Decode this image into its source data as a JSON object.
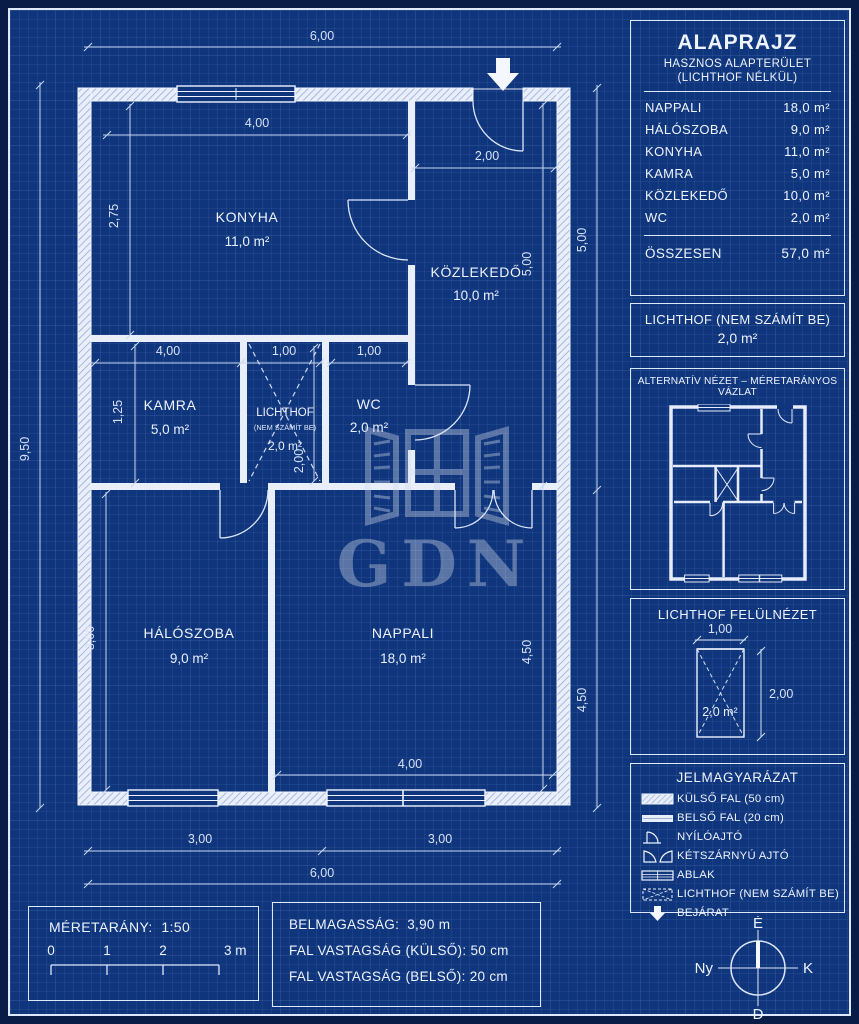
{
  "watermark": "GDN",
  "plan": {
    "rooms": {
      "konyha": {
        "name": "KONYHA",
        "area": "11,0 m²"
      },
      "kozlekedo": {
        "name": "KÖZLEKEDŐ",
        "area": "10,0 m²"
      },
      "kamra": {
        "name": "KAMRA",
        "area": "5,0 m²"
      },
      "lichthof": {
        "name": "LICHTHOF",
        "note": "(NEM SZÁMÍT BE)",
        "area": "2,0 m²"
      },
      "wc": {
        "name": "WC",
        "area": "2,0 m²"
      },
      "haloszoba": {
        "name": "HÁLÓSZOBA",
        "area": "9,0 m²"
      },
      "nappali": {
        "name": "NAPPALI",
        "area": "18,0 m²"
      }
    },
    "dims": {
      "top_total": "6,00",
      "konyha_w": "4,00",
      "entrance_w": "2,00",
      "konyha_h": "2,75",
      "kozlekedo_h": "5,00",
      "right_upper": "5,00",
      "right_lower": "4,50",
      "nappali_h": "4,50",
      "left_total": "9,50",
      "kamra_w": "4,00",
      "lichthof_w": "1,00",
      "wc_w": "1,00",
      "kamra_h": "1,25",
      "lichthof_h": "2,00",
      "haloszoba_h": "3,00",
      "nappali_w": "4,00",
      "bottom_left": "3,00",
      "bottom_right": "3,00",
      "bottom_total": "6,00"
    }
  },
  "sidebar": {
    "summary": {
      "title": "ALAPRAJZ",
      "subtitle1": "HASZNOS ALAPTERÜLET",
      "subtitle2": "(LICHTHOF NÉLKÜL)",
      "rows": [
        {
          "label": "NAPPALI",
          "value": "18,0 m²"
        },
        {
          "label": "HÁLÓSZOBA",
          "value": "9,0 m²"
        },
        {
          "label": "KONYHA",
          "value": "11,0 m²"
        },
        {
          "label": "KAMRA",
          "value": "5,0 m²"
        },
        {
          "label": "KÖZLEKEDŐ",
          "value": "10,0 m²"
        },
        {
          "label": "WC",
          "value": "2,0 m²"
        }
      ],
      "total_label": "ÖSSZESEN",
      "total_value": "57,0 m²"
    },
    "lichthof_note": {
      "line1": "LICHTHOF (NEM SZÁMÍT BE)",
      "line2": "2,0 m²"
    },
    "alt_view": {
      "caption": "ALTERNATÍV NÉZET – MÉRETARÁNYOS VÁZLAT"
    },
    "lichthof_top": {
      "title": "LICHTHOF FELÜLNÉZET",
      "width": "1,00",
      "height": "2,00",
      "area": "2,0 m²"
    },
    "legend": {
      "title": "JELMAGYARÁZAT",
      "items": [
        {
          "label": "KÜLSŐ FAL (50 cm)"
        },
        {
          "label": "BELSŐ FAL (20 cm)"
        },
        {
          "label": "NYÍLÓAJTÓ"
        },
        {
          "label": "KÉTSZÁRNYÚ AJTÓ"
        },
        {
          "label": "ABLAK"
        },
        {
          "label": "LICHTHOF (NEM SZÁMÍT BE)"
        },
        {
          "label": "BEJÁRAT"
        }
      ]
    },
    "compass": {
      "n": "É",
      "w": "Ny",
      "e": "K",
      "s": "D"
    }
  },
  "footer": {
    "scale": {
      "label": "MÉRETARÁNY:",
      "value": "1:50",
      "ticks": [
        "0",
        "1",
        "2",
        "3 m"
      ]
    },
    "info": {
      "rows": [
        {
          "label": "BELMAGASSÁG:",
          "value": "3,90 m"
        },
        {
          "label": "FAL VASTAGSÁG (KÜLSŐ):",
          "value": "50 cm"
        },
        {
          "label": "FAL VASTAGSÁG (BELSŐ):",
          "value": "20 cm"
        }
      ]
    }
  },
  "colors": {
    "field": "#0f357c",
    "line": "#eef3fd",
    "dim": "#c9d7f0"
  }
}
